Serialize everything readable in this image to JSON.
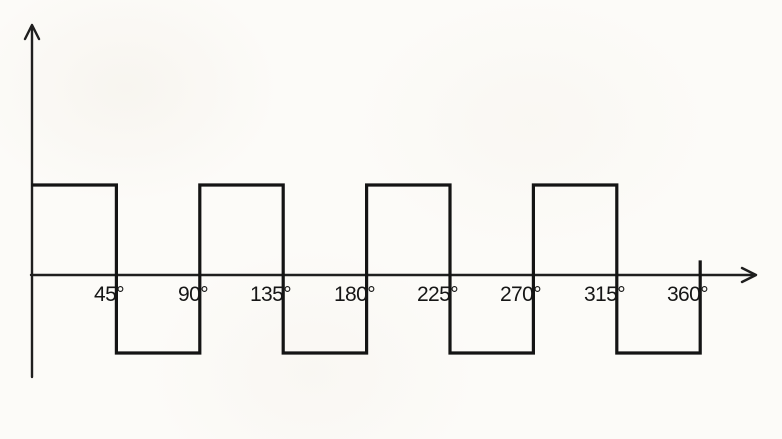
{
  "figure": {
    "description": "Square wave plotted against phase angle in degrees",
    "background_color": "#fcfbf8",
    "axis_color": "#1f1f1f",
    "line_color": "#141414",
    "text_color": "#161616"
  },
  "chart_data": {
    "type": "line",
    "subtype": "square-wave-step",
    "title": "",
    "xlabel": "",
    "ylabel": "",
    "x_unit": "degrees",
    "x_tick_labels": [
      "45°",
      "90°",
      "135°",
      "180°",
      "225°",
      "270°",
      "315°",
      "360°"
    ],
    "x_tick_values": [
      45,
      90,
      135,
      180,
      225,
      270,
      315,
      360
    ],
    "xlim": [
      0,
      360
    ],
    "ylim": [
      -1,
      1
    ],
    "segment_width_deg": 45,
    "levels": [
      1,
      -1,
      1,
      -1,
      1,
      -1,
      1,
      -1
    ],
    "amplitude_high": 1,
    "amplitude_low": -1,
    "period_deg": 90,
    "end_tick_deg": 360,
    "grid": false,
    "legend": false
  }
}
